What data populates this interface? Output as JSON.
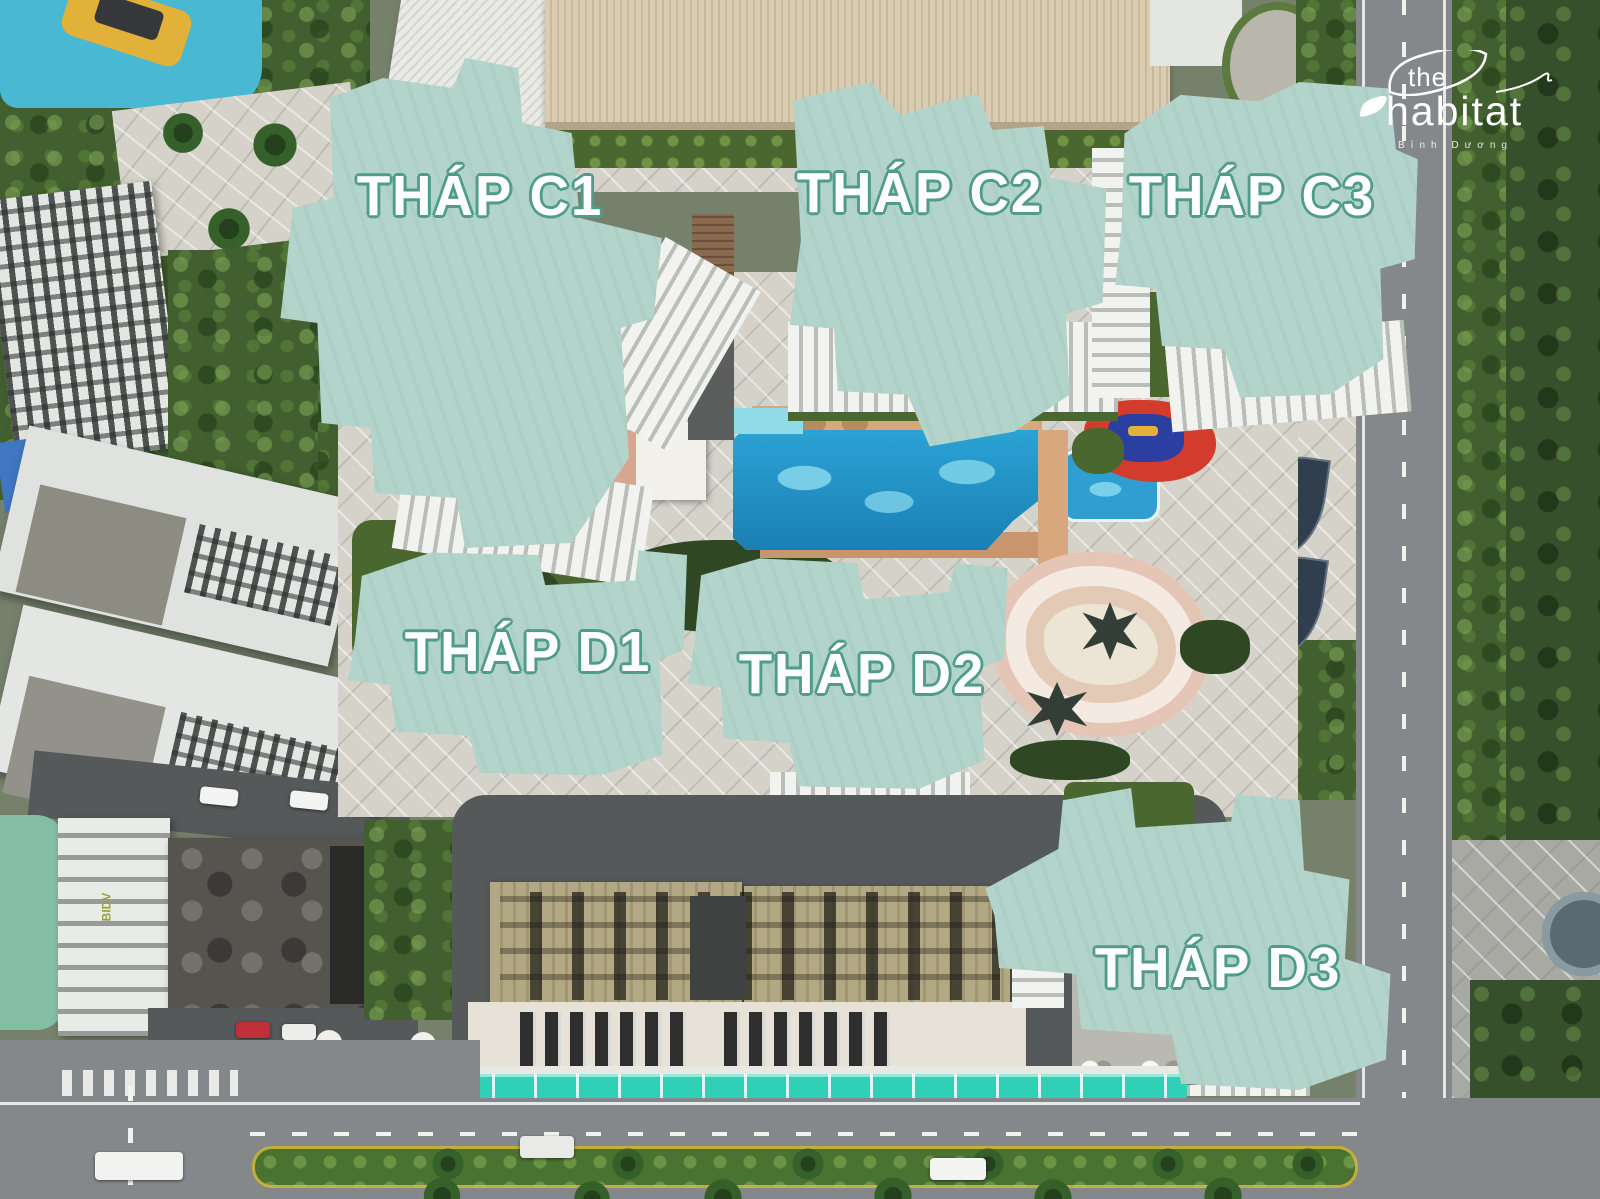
{
  "logo": {
    "prefix": "the",
    "name": "habitat",
    "subtitle": "Bình Dương"
  },
  "towers": [
    {
      "label": "THÁP C1"
    },
    {
      "label": "THÁP C2"
    },
    {
      "label": "THÁP C3"
    },
    {
      "label": "THÁP D1"
    },
    {
      "label": "THÁP D2"
    },
    {
      "label": "THÁP D3"
    }
  ],
  "landmarks": {
    "bidv": "BIDV"
  },
  "colors": {
    "overlay_fill": "#a9cfc6",
    "overlay_edge": "#4f9c8a",
    "label_text": "#ffffff",
    "label_outline": "#4f9c8a",
    "pool_water": "#2196c8",
    "canopy_teal": "#2fd0b5",
    "playground_red": "#d33b2c",
    "playground_blue": "#2b3fa0"
  }
}
